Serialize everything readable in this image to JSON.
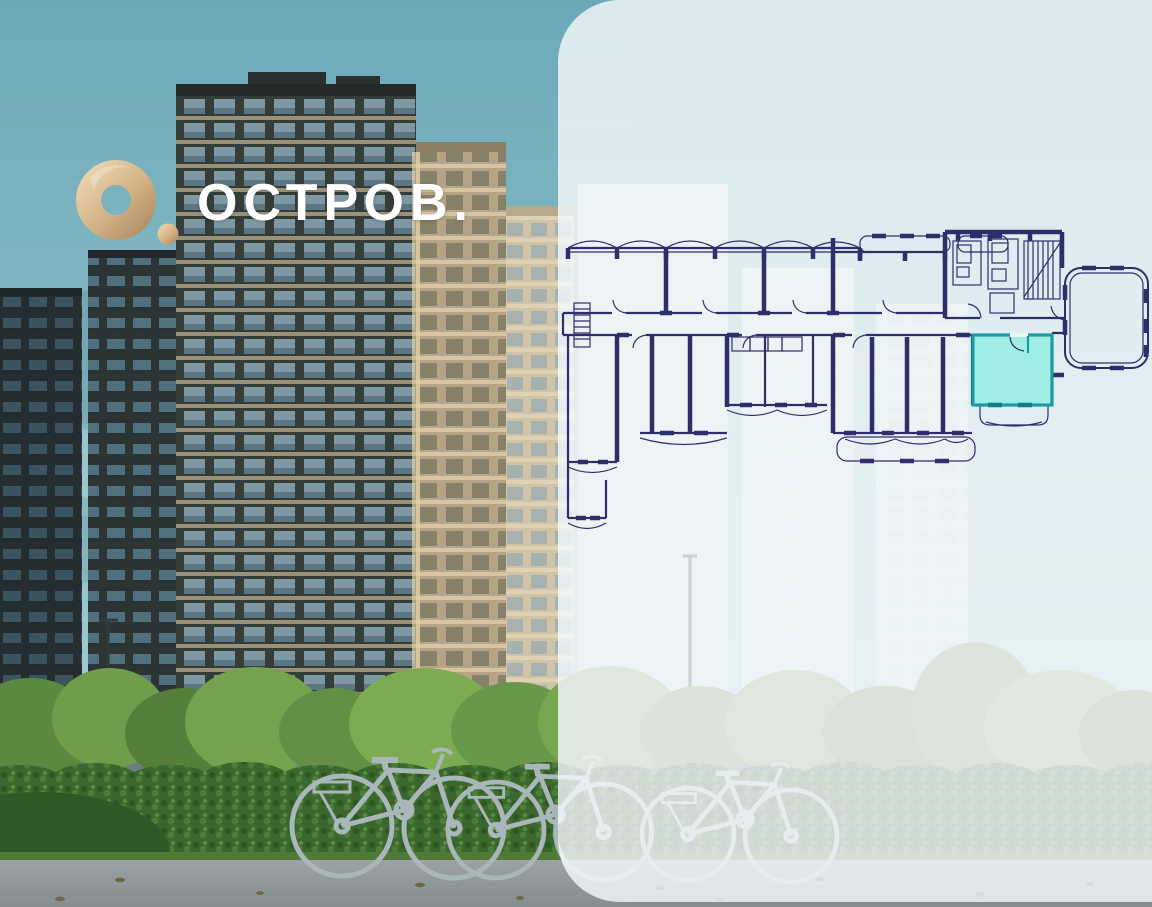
{
  "logo": {
    "text": "ОСТРОВ."
  },
  "panel": {
    "floor_plan": {
      "description": "floor plan with one highlighted apartment",
      "line_color": "#2d2f6b",
      "highlight_fill": "#9feee6",
      "highlight_stroke": "#1d9aa0"
    },
    "stats": [
      {
        "value": "1",
        "label": "КОРПУС"
      },
      {
        "value": "1",
        "label": "СЕКЦИЯ"
      },
      {
        "value": "2",
        "label": "ЭТАЖ"
      }
    ]
  },
  "colors": {
    "accent_purple": "#4a3e99",
    "panel_background": "#edf4f6",
    "logo_gold": "#c9a474",
    "sky_teal": "#6ca9b8"
  }
}
